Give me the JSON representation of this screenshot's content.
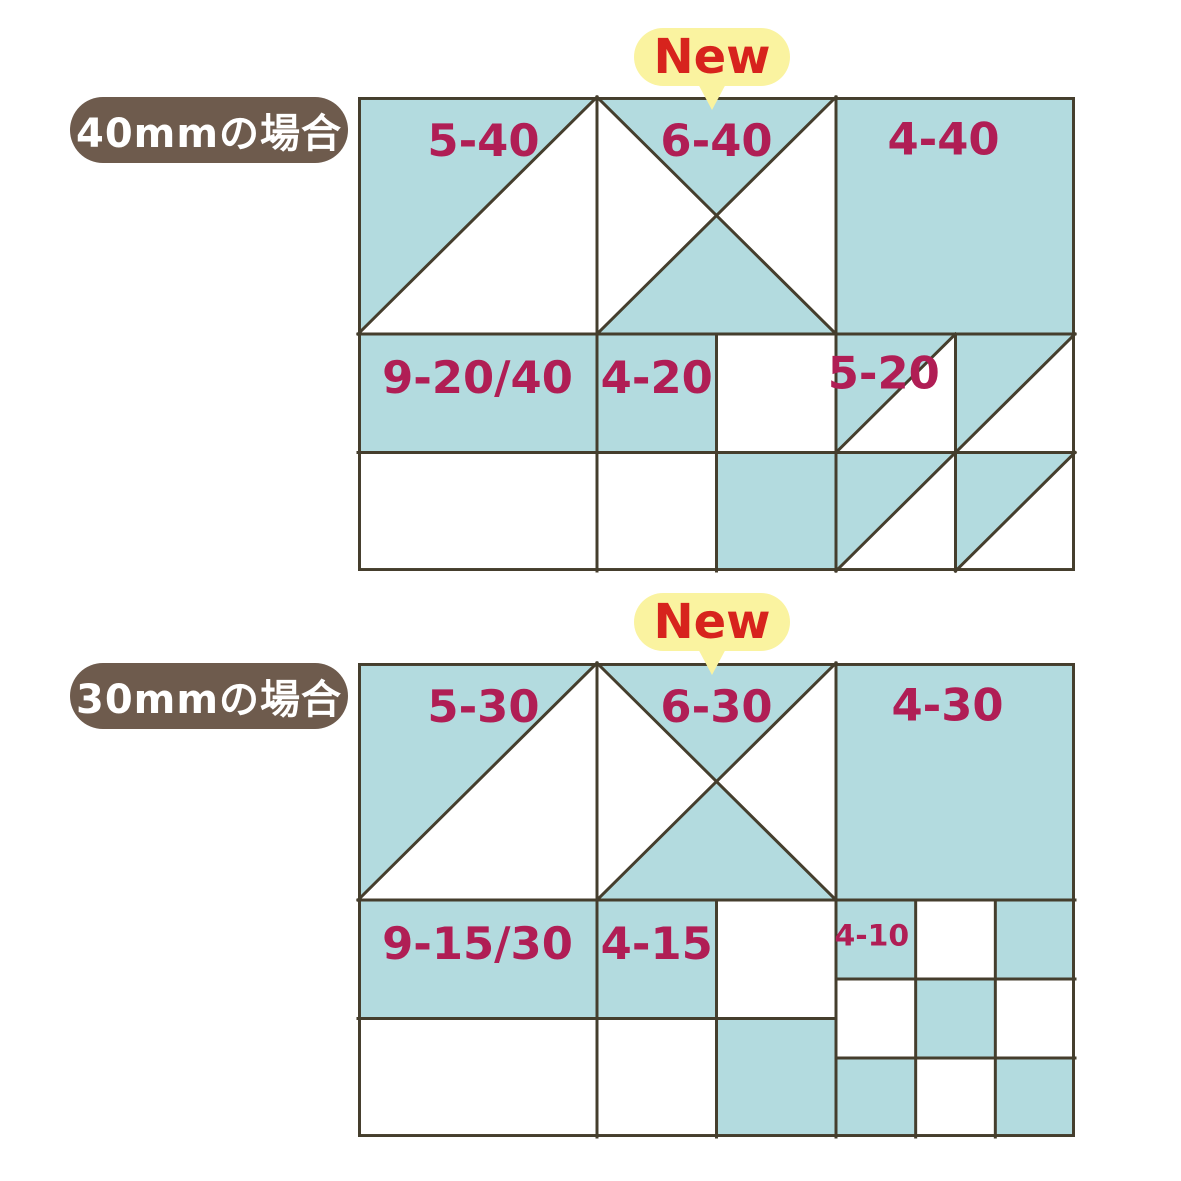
{
  "colors": {
    "teal": "#b3dbdf",
    "grid-line": "#453e2d",
    "label": "#b01e55",
    "badge-bg": "#faf3a0",
    "badge-text": "#d7231d",
    "pill-bg": "#6e5b4d",
    "pill-text": "#ffffff"
  },
  "sections": [
    {
      "title": "40mmの場合",
      "badge": "New",
      "labels": {
        "hst_large": "5-40",
        "hourglass": "6-40",
        "square_large": "4-40",
        "rect_wide": "9-20/40",
        "square_small": "4-20",
        "hst_small": "5-20"
      }
    },
    {
      "title": "30mmの場合",
      "badge": "New",
      "labels": {
        "hst_large": "5-30",
        "hourglass": "6-30",
        "square_large": "4-30",
        "rect_wide": "9-15/30",
        "square_small": "4-15",
        "checkerboard": "4-10"
      }
    }
  ]
}
